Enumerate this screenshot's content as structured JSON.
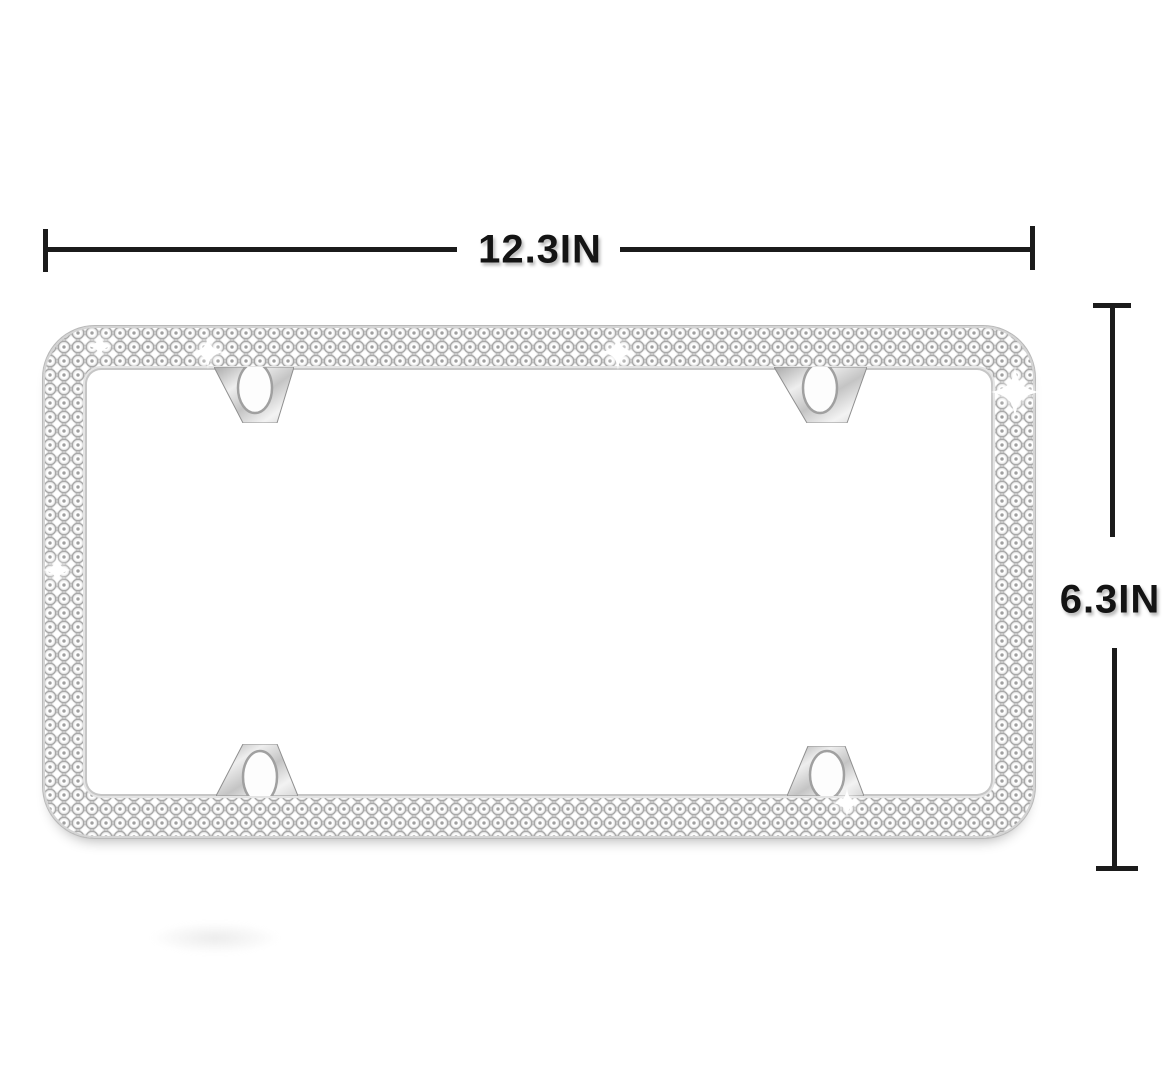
{
  "dimensions": {
    "width_label": "12.3IN",
    "height_label": "6.3IN"
  },
  "frame_figure": {
    "crystal_rows": 3,
    "mounting_tabs": 4,
    "screw_holes": 4,
    "sparkle_glints": 6
  },
  "style": {
    "background_color": "#ffffff",
    "annotation_line_color": "#1b1b1b",
    "annotation_text_color": "#141414",
    "crystal_base_color": "#ececec",
    "crystal_ring_color": "#969696",
    "metal_color": "#c9c9c9"
  }
}
